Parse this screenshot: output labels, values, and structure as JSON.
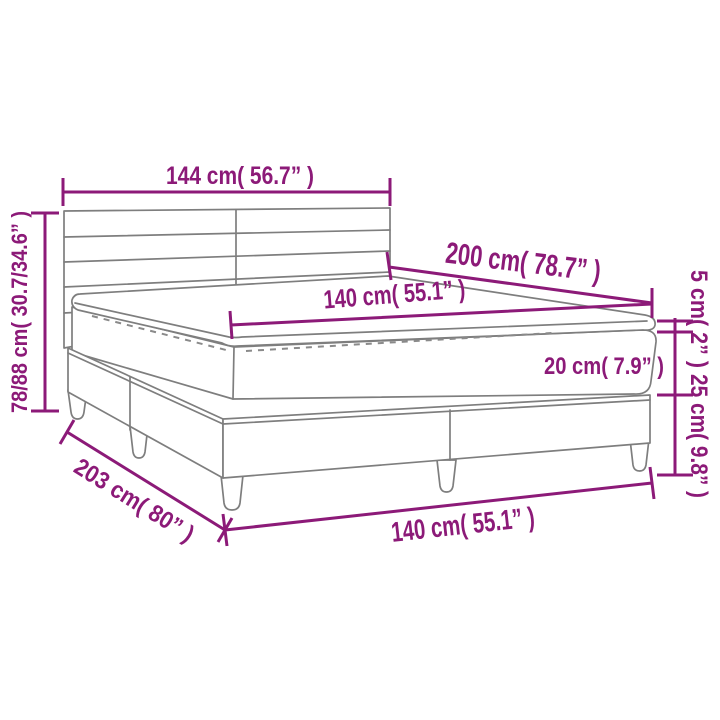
{
  "diagram": {
    "type": "product-dimension-diagram",
    "subject": "box-spring-bed-with-headboard-and-mattress-topper",
    "labels": {
      "headboard_width": "144 cm( 56.7” )",
      "total_height": "78/88 cm( 30.7/34.6” )",
      "bed_length": "200 cm( 78.7” )",
      "mattress_width": "140 cm( 55.1” )",
      "topper_height": "5 cm( 2” )",
      "mattress_height": "20 cm( 7.9” )",
      "base_height": "25 cm( 9.8” )",
      "total_length": "203 cm( 80” )",
      "base_width": "140 cm( 55.1” )"
    },
    "colors": {
      "dimension_accent": "#8C1A78",
      "drawing_line": "#7E7E7E",
      "background": "#FFFFFF"
    }
  }
}
